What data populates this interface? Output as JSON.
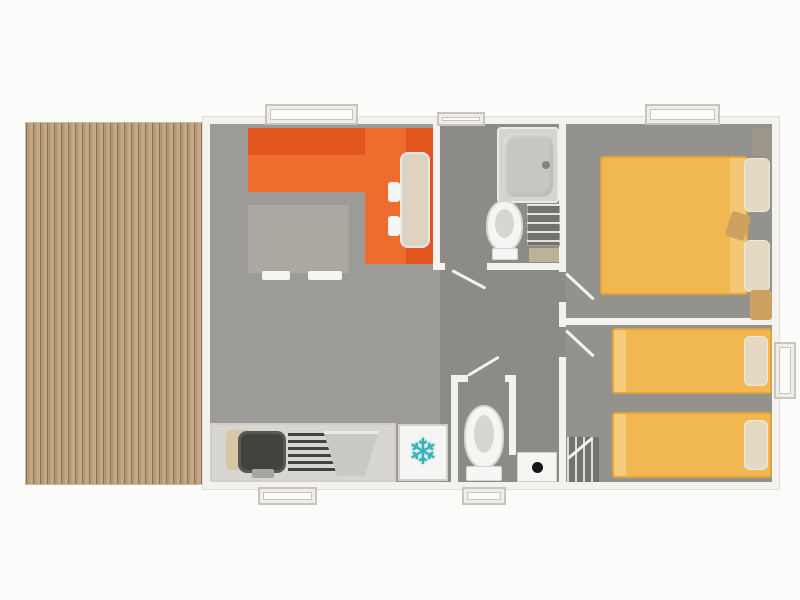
{
  "canvas": {
    "width": 800,
    "height": 600
  },
  "icons": {
    "snowflake_glyph": "❄"
  },
  "colors": {
    "page_bg": "#fbfbf9",
    "deck_light": "#c3aa87",
    "deck_mid": "#b29874",
    "deck_dark": "#8d7253",
    "wall": "#f3f2ef",
    "wall_edge": "#e1deda",
    "living_floor": "#9c9b97",
    "wet_floor": "#8c8b88",
    "bedroom_floor": "#93928d",
    "sofa_orange": "#ee6c2e",
    "sofa_dark": "#e2551e",
    "table_beige": "#ddd3c0",
    "coffee_table": "#ada7a1",
    "counter": "#d8d6d1",
    "counter_edge": "#d2cfca",
    "sink_dark": "#43423c",
    "metal": "#a8a6a1",
    "metal_light": "#cbc9c4",
    "fixture_white": "#f5f5f3",
    "fixture_edge": "#eceae7",
    "fixture_shadow": "#d7d6d3",
    "shower_tray": "#d5d4d1",
    "shower_basin": "#c7c6c3",
    "drain": "#84837f",
    "shelf_dark": "#73726c",
    "mat_tan": "#d8c6a6",
    "mat_olive": "#beb296",
    "bed_yellow": "#f1b851",
    "bed_edge": "#e2a33c",
    "pillow": "#e4dac4",
    "wardrobe_gray": "#9d968c",
    "bench_tan": "#cda261",
    "snowflake_teal": "#2fb4b8",
    "window_frame": "#efedea",
    "window_edge": "#c8c5bf",
    "window_inner": "#fbfbf9",
    "machine_dot": "#161616"
  }
}
